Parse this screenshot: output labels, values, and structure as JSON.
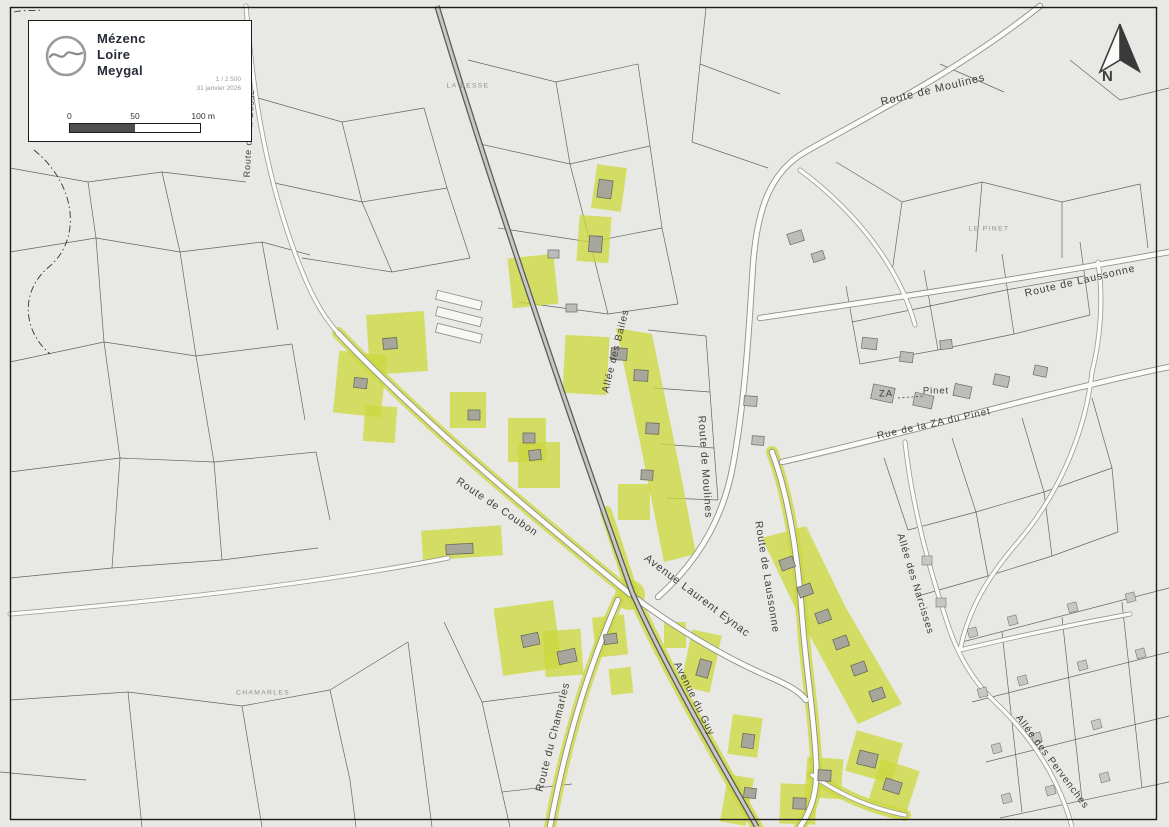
{
  "legend": {
    "org": {
      "line1": "Mézenc",
      "line2": "Loire",
      "line3": "Meygal"
    },
    "scale_ratio": "1 / 2 500",
    "date": "31 janvier 2026",
    "scalebar": {
      "start": "0",
      "mid": "50",
      "end": "100 m"
    }
  },
  "north": {
    "label": "N"
  },
  "map": {
    "colors": {
      "highlight": "#cdd83f",
      "background": "#e8e8e5",
      "road_fill": "#fbfbf9",
      "parcel_line": "#454545"
    },
    "road_labels": [
      {
        "id": "route-de-moulines-top",
        "text": "Route de Moulines"
      },
      {
        "id": "route-de-laussonne-top",
        "text": "Route de Laussonne"
      },
      {
        "id": "route-de-la-besse",
        "text": "Route de la Besse"
      },
      {
        "id": "allee-des-bailes",
        "text": "Allée des Bailes"
      },
      {
        "id": "route-de-moulines-center",
        "text": "Route de Moulines"
      },
      {
        "id": "route-de-coubon",
        "text": "Route de Coubon"
      },
      {
        "id": "avenue-laurent-eynac",
        "text": "Avenue Laurent Eynac"
      },
      {
        "id": "route-de-laussonne-center",
        "text": "Route de Laussonne"
      },
      {
        "id": "avenue-du-guy",
        "text": "Avenue du Guy"
      },
      {
        "id": "route-du-chamarles",
        "text": "Route du Chamarles"
      },
      {
        "id": "rue-de-la-za-du-pinet",
        "text": "Rue de la ZA du Pinet"
      },
      {
        "id": "za",
        "text": "ZA"
      },
      {
        "id": "pinet",
        "text": "Pinet"
      },
      {
        "id": "allee-des-narcisses",
        "text": "Allée des Narcisses"
      },
      {
        "id": "allee-des-pervenches",
        "text": "Allée des Pervenches"
      }
    ],
    "place_labels": [
      {
        "id": "la-besse",
        "text": "LA BESSE"
      },
      {
        "id": "le-pinet",
        "text": "LE PINET"
      },
      {
        "id": "chamarles",
        "text": "CHAMARLES"
      }
    ]
  }
}
